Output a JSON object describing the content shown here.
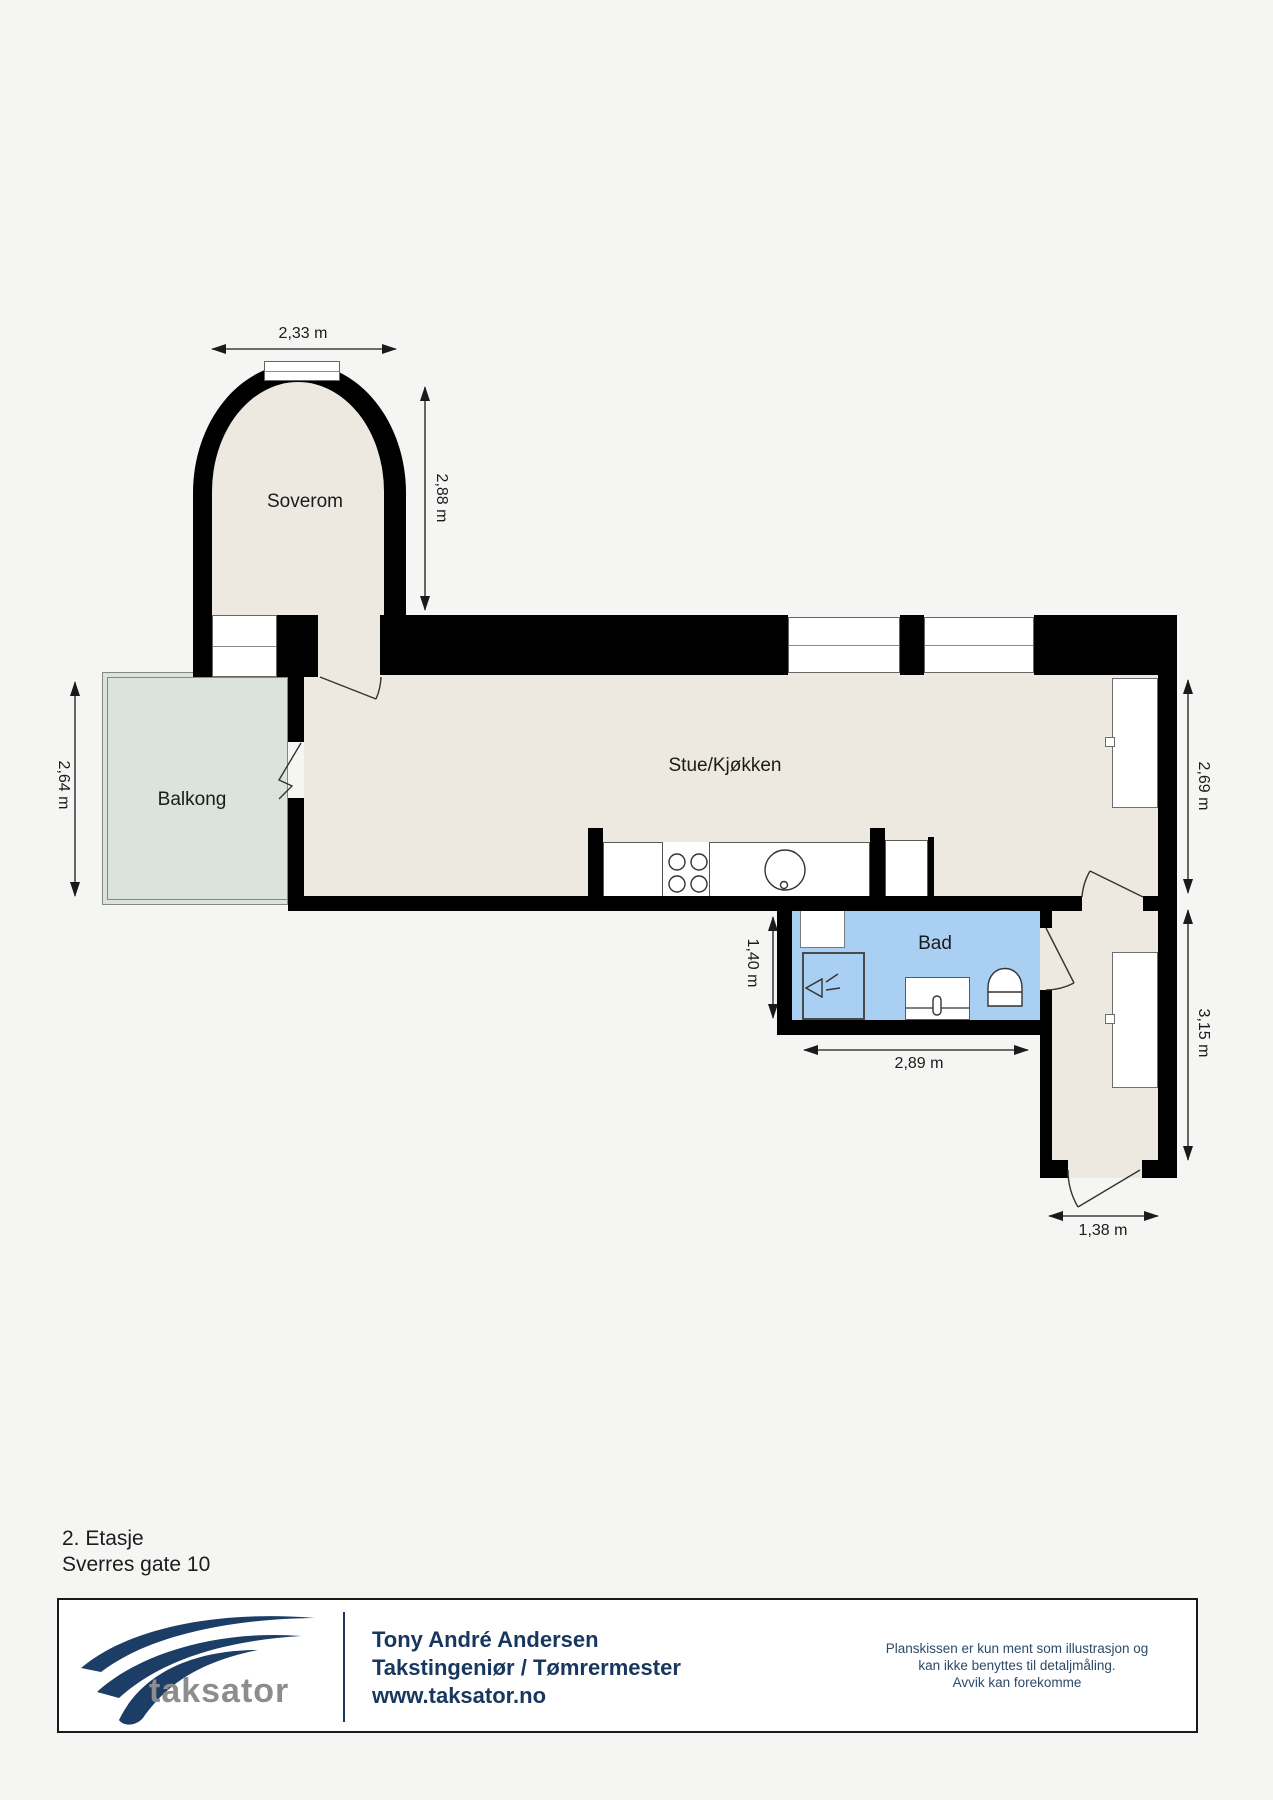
{
  "colors": {
    "bg": "#f5f5f4",
    "wall": "#000000",
    "floor": "#ede9e0",
    "balcony": "#dce3dd",
    "bath": "#a9cff2",
    "navy": "#17375e",
    "logo_gray": "#8d8d8d"
  },
  "plan": {
    "rooms": {
      "soverom": "Soverom",
      "balkong": "Balkong",
      "stue_kjokken": "Stue/Kjøkken",
      "bad": "Bad"
    },
    "dimensions": {
      "bedroom_width": "2,33 m",
      "bedroom_height": "2,88 m",
      "balcony_depth": "2,64 m",
      "living_right": "2,69 m",
      "bath_depth": "1,40 m",
      "bath_width": "2,89 m",
      "hall_height": "3,15 m",
      "entry_width": "1,38 m"
    }
  },
  "footer": {
    "floor_label": "2. Etasje",
    "address": "Sverres gate 10",
    "logo_text": "taksator",
    "contact_name": "Tony André Andersen",
    "contact_title": "Takstingeniør / Tømrermester",
    "contact_url": "www.taksator.no",
    "disclaimer_line1": "Planskissen er kun ment som illustrasjon og",
    "disclaimer_line2": "kan ikke benyttes til detaljmåling.",
    "disclaimer_line3": "Avvik kan forekomme"
  }
}
